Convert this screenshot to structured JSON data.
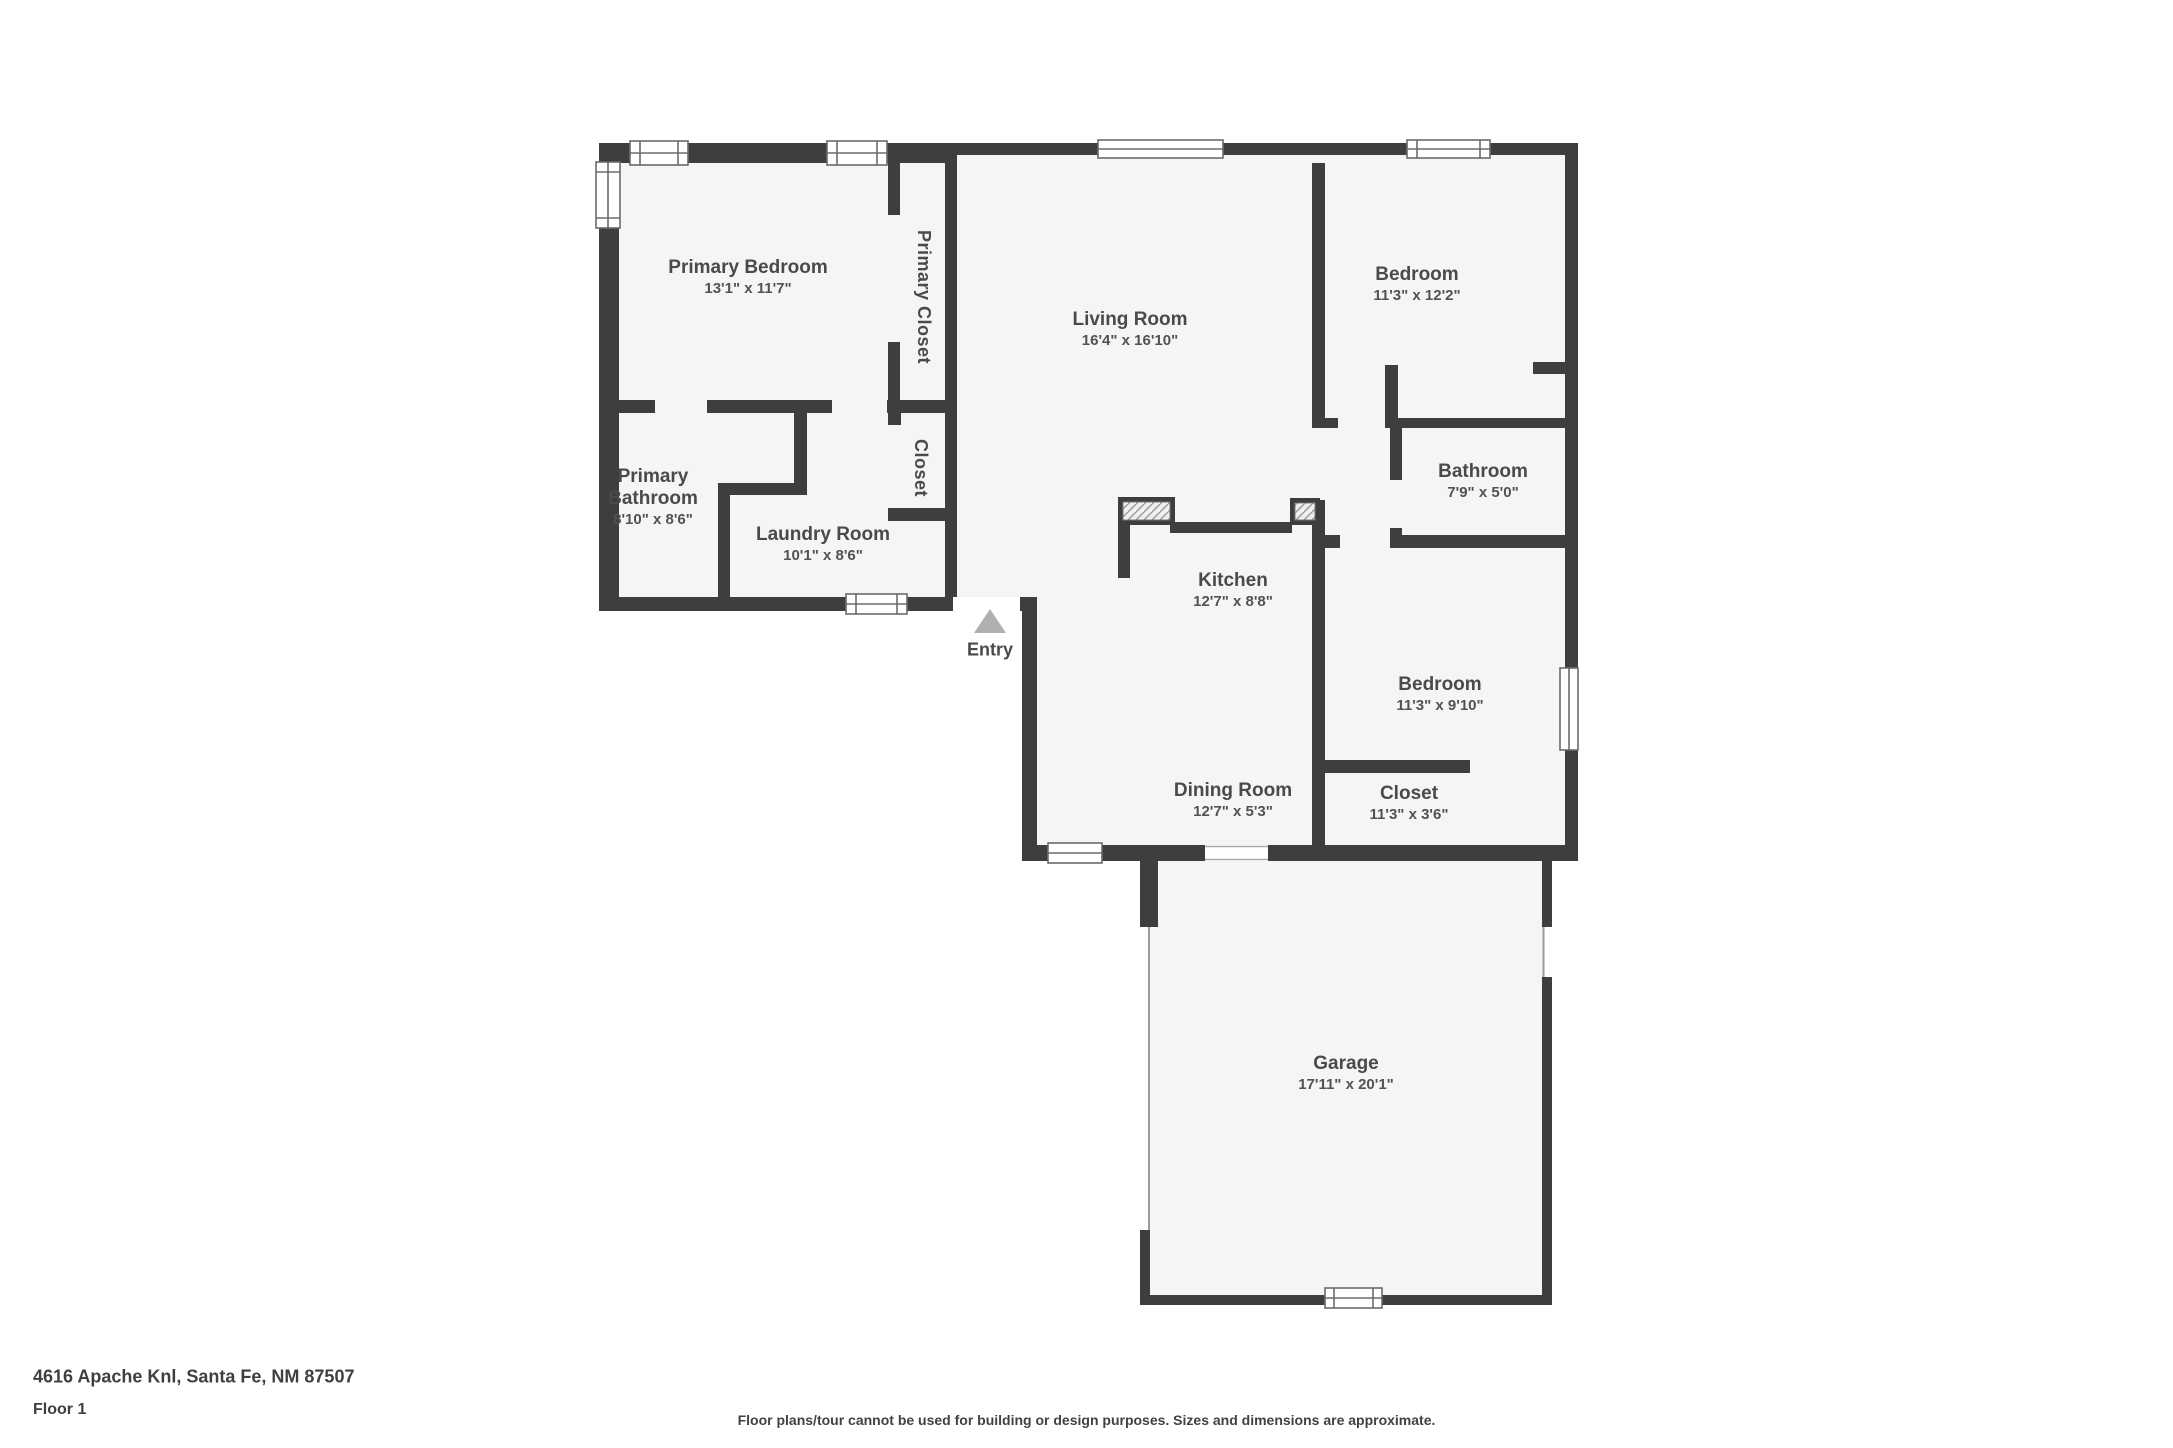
{
  "floorplan": {
    "rooms": {
      "primary_bedroom": {
        "name": "Primary Bedroom",
        "dims": "13'1\" x 11'7\""
      },
      "primary_closet": {
        "name": "Primary Closet",
        "dims": ""
      },
      "living_room": {
        "name": "Living Room",
        "dims": "16'4\" x 16'10\""
      },
      "bedroom_top": {
        "name": "Bedroom",
        "dims": "11'3\" x 12'2\""
      },
      "primary_bathroom": {
        "name": "Primary Bathroom",
        "dims": "8'10\" x 8'6\""
      },
      "laundry_room": {
        "name": "Laundry Room",
        "dims": "10'1\" x 8'6\""
      },
      "hall_closet": {
        "name": "Closet",
        "dims": ""
      },
      "bathroom": {
        "name": "Bathroom",
        "dims": "7'9\" x 5'0\""
      },
      "kitchen": {
        "name": "Kitchen",
        "dims": "12'7\" x 8'8\""
      },
      "bedroom_right": {
        "name": "Bedroom",
        "dims": "11'3\" x 9'10\""
      },
      "dining_room": {
        "name": "Dining Room",
        "dims": "12'7\" x 5'3\""
      },
      "bedroom_closet": {
        "name": "Closet",
        "dims": "11'3\" x 3'6\""
      },
      "garage": {
        "name": "Garage",
        "dims": "17'11\" x 20'1\""
      }
    },
    "entry_label": "Entry"
  },
  "footer": {
    "address": "4616 Apache Knl, Santa Fe, NM 87507",
    "floor_label": "Floor 1",
    "disclaimer": "Floor plans/tour cannot be used for building or design purposes. Sizes and dimensions are approximate."
  },
  "colors": {
    "wall": "#3e3e3e",
    "floor": "#f5f5f5",
    "outside": "#ffffff",
    "entry_arrow": "#b0b0b0",
    "label_text": "#4a4a4a",
    "window_outline": "#6b6b6b"
  }
}
